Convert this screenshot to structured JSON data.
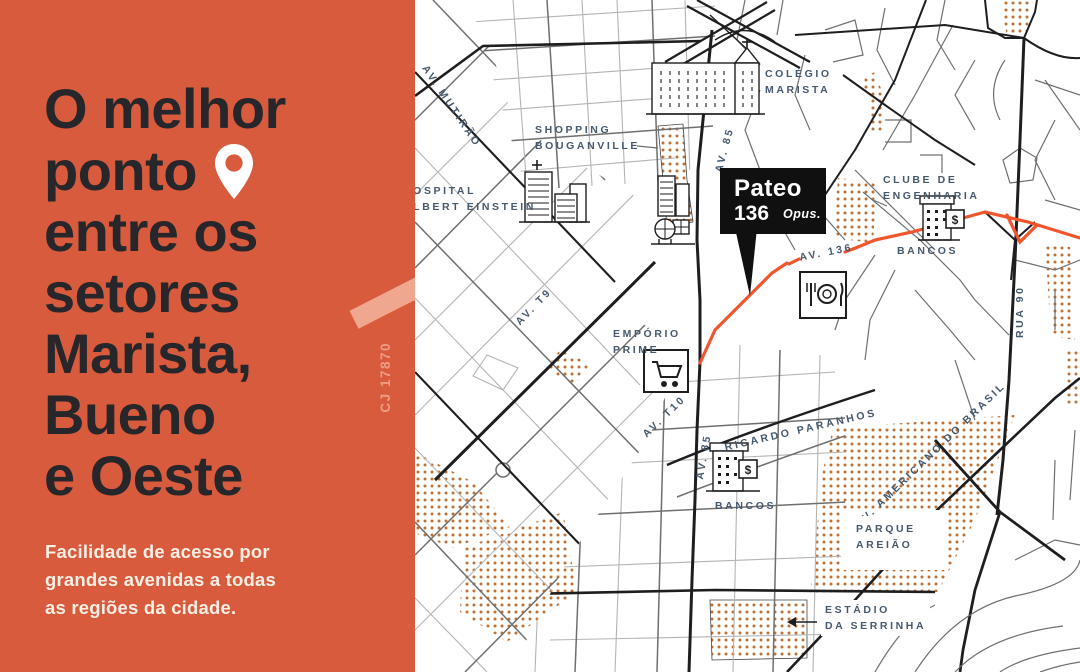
{
  "left_panel": {
    "headline_lines": [
      "O melhor",
      "ponto",
      "entre os",
      "setores",
      "Marista,",
      "Bueno",
      "e Oeste"
    ],
    "subtext_lines": [
      "Facilidade de acesso por",
      "grandes avenidas a todas",
      "as regiões da cidade."
    ],
    "side_code": "CJ 17870",
    "colors": {
      "background": "#D85B3D",
      "headline": "#26262B",
      "subtext": "#FAEFE5",
      "accent_light": "#EC9E85"
    }
  },
  "callout": {
    "name": "Pateo",
    "number": "136",
    "brand": "Opus."
  },
  "map": {
    "bank_symbol": "$",
    "colors": {
      "label": "#46586C",
      "route": "#F2552B",
      "dots": "#BE7134",
      "street_dark": "#1E1E20"
    },
    "labels": {
      "av_mutirao": "AV. MUTIRÃO",
      "shopping_l1": "SHOPPING",
      "shopping_l2": "BOUGANVILLE",
      "colegio_l1": "COLÉGIO",
      "colegio_l2": "MARISTA",
      "hospital_l1": "HOSPITAL",
      "hospital_l2": "ALBERT EINSTEIN",
      "av85_a": "AV. 85",
      "av85_b": "AV. 85",
      "av136": "AV. 136",
      "av_t9": "AV. T9",
      "av_t10": "AV. T10",
      "clube_l1": "CLUBE DE",
      "clube_l2": "ENGENHARIA",
      "bancos_1": "BANCOS",
      "bancos_2": "BANCOS",
      "emporio_l1": "EMPÓRIO",
      "emporio_l2": "PRIME",
      "ricardo": "RICARDO PARANHOS",
      "americano": "AV. AMERICANO DO BRASIL",
      "rua90": "RUA 90",
      "parque_l1": "PARQUE",
      "parque_l2": "AREIÃO",
      "estadio_l1": "ESTÁDIO",
      "estadio_l2": "DA SERRINHA"
    }
  }
}
